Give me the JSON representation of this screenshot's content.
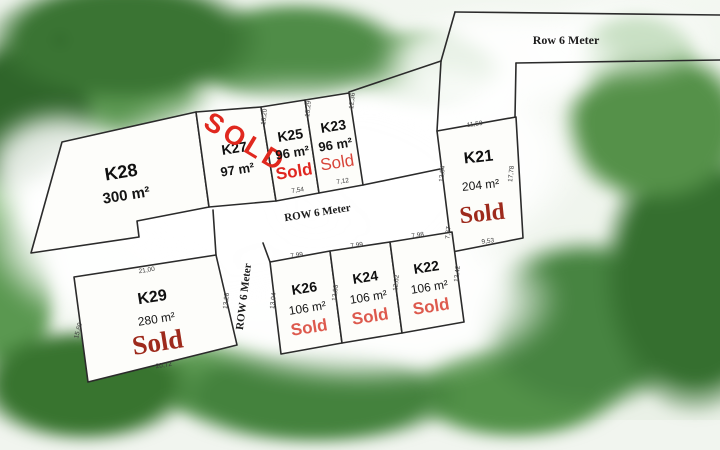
{
  "roads": {
    "top_label": "Row 6 Meter",
    "middle_label": "ROW 6 Meter",
    "vertical_label": "ROW 6 Meter"
  },
  "plots": [
    {
      "id": "K28",
      "area": "300 m²",
      "status": ""
    },
    {
      "id": "K27",
      "area": "97 m²",
      "status": "SOLD"
    },
    {
      "id": "K25",
      "area": "96 m²",
      "status": "Sold"
    },
    {
      "id": "K23",
      "area": "96 m²",
      "status": "Sold"
    },
    {
      "id": "K21",
      "area": "204 m²",
      "status": "Sold"
    },
    {
      "id": "K26",
      "area": "106 m²",
      "status": "Sold"
    },
    {
      "id": "K24",
      "area": "106 m²",
      "status": "Sold"
    },
    {
      "id": "K22",
      "area": "106 m²",
      "status": "Sold"
    },
    {
      "id": "K29",
      "area": "280 m²",
      "status": "Sold"
    }
  ],
  "dimensions": {
    "k25_left": "13,20",
    "k23_left": "13,29",
    "k23_right": "12,36",
    "k25_bottom": "7,54",
    "k23_bottom": "7,12",
    "k21_top": "11,50",
    "k21_left": "12,84",
    "k21_right": "17,78",
    "k21_left_lower": "7,37",
    "k21_bottom": "9,53",
    "k26_top": "7,99",
    "k24_top": "7,99",
    "k22_top": "7,98",
    "k26_left": "13,04",
    "k24_left": "12,83",
    "k22_left": "12,62",
    "k22_right": "12,42",
    "k29_top": "21,00",
    "k29_left": "15,69",
    "k29_right": "13,28",
    "k29_bottom": "20,72"
  },
  "colors": {
    "sold_bright": "#e02620",
    "sold_soft": "#dd5a4e",
    "sold_dark": "#9e2a1c",
    "line": "#2b2b2b",
    "tree_green": "#44823d"
  }
}
